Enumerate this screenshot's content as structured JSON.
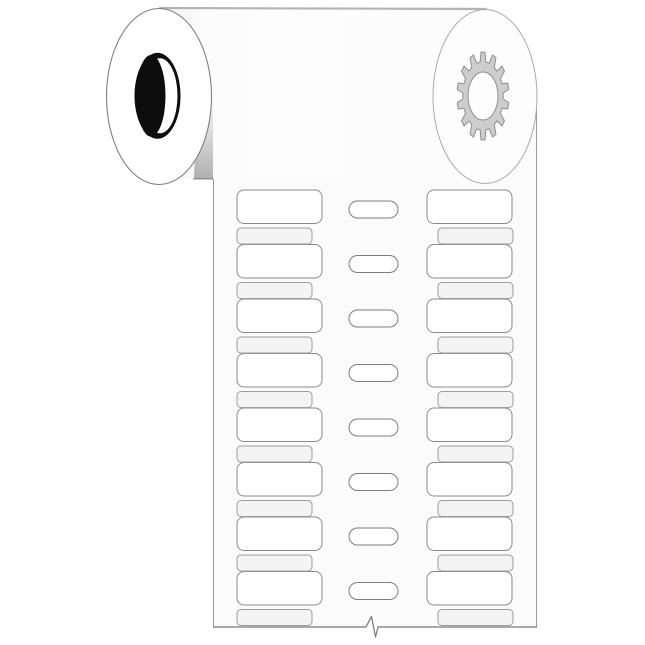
{
  "page": {
    "background_color": "#ffffff"
  },
  "illustration": {
    "type": "product-line-art",
    "subject": "roll of two-across printer labels with central sprocket feed slots",
    "roll": {
      "body_fill": "#fcfcfc",
      "body_shade_fill": "#f1f1f1",
      "top_edge_color": "#b4b4b4",
      "left_disc": {
        "fill": "#ffffff",
        "stroke": "#7f7f7f",
        "core_color": "#0d0d0d",
        "core_highlight": "#ffffff"
      },
      "right_disc": {
        "fill": "#fdfdfd",
        "stroke": "#a9a9a9",
        "gear_teeth": 14,
        "gear_fill": "#cdcdcd",
        "gear_stroke": "#8f8f8f"
      },
      "shadow_color_start": "rgba(0,0,0,0)",
      "shadow_color_end": "rgba(0,0,0,0.30)"
    },
    "strip": {
      "fill": "#fbfbfb",
      "edge_stroke": "#9a9a9a",
      "bottom_edge_stroke": "#777777",
      "label_columns": 2,
      "labels_per_column": 8,
      "label_fill": "#ffffff",
      "label_stroke": "#8a8a8a",
      "spacers_per_column": 8,
      "spacer_fill": "#f4f4f4",
      "spacer_stroke": "#9c9c9c",
      "feed_slot_count": 8,
      "feed_slot_fill": "#ffffff",
      "feed_slot_stroke": "#7d7d7d",
      "has_tear_mark": true
    }
  }
}
